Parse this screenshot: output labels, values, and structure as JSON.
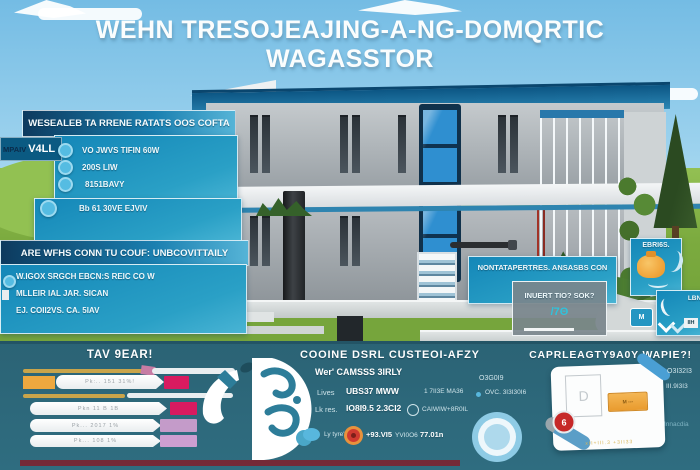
{
  "title": "WEHN TRESOJEAJING-A-NG-DOMQRTIC WAGASSTOR",
  "colors": {
    "sky": "#8fcbe9",
    "grass": "#7cab3f",
    "panel_teal": "#1f93c0",
    "panel_navy": "#0d3a5e",
    "band": "#2d6879",
    "roof_blue": "#1e6f9e",
    "glass_blue": "#2f8fd0",
    "accent_orange": "#eda83f",
    "accent_gold": "#c9a44a",
    "accent_magenta": "#d81b60",
    "accent_plum": "#c79fcb",
    "maroon_strip": "#7c2430",
    "ring_blue": "#8ecbe5",
    "badge_red": "#c62828"
  },
  "left_panel": {
    "tab_dark": "MPAIV",
    "tab_light": "V4LL",
    "header": "WESEALEB TA RRENE RATATS OOS COFTA",
    "items": [
      "VO JWVS TIFIN 60W",
      "200S LIW",
      "8151BAVY",
      "Bb 61 30VE EJVIV"
    ]
  },
  "info_panel": {
    "header": "ARE WFHS CONN TU COUF: UNBCOVITTAILY",
    "lines": [
      "W.IGOX SRGCH EBCN:S REIC CO W",
      "MLLEIR IAL JAR. SICAN",
      "EJ. COII2VS. CA.   5IAV"
    ]
  },
  "callout_panel": {
    "header": "NONTATAPERTRES. ANSASBS CON",
    "label": "INUERT TIO? SOK?",
    "value": "/7Θ"
  },
  "badge_panel": {
    "label": "EBRI6S."
  },
  "mini_panel": {
    "label": "LBNI",
    "value": "IIH",
    "monogram": "M"
  },
  "bottom": {
    "col1": {
      "title": "TAV 9EAR!",
      "bars": [
        {
          "label": "Pk:.. 151    31%!"
        },
        {
          "label": "Pkn 11 B       1B"
        },
        {
          "label": "Pk... 2017     1%"
        },
        {
          "label": "Pk...  108      1%"
        }
      ]
    },
    "col2": {
      "title": "COOINE DSRL CUSTEOI-AFZY",
      "subtitle": "Wer' CAMSSS 3IRLY",
      "row1_label": "Lives",
      "row1_value": "UBS37 MWW",
      "row1_right": "1 7II3E   MA36",
      "row2_label": "Lk res.",
      "row2_value": "IO8I9.5 2.3CI2",
      "row2_right": "CAIWIW+8R0IL",
      "foot_label": "Ly tyre'",
      "foot_v1": "+93.VI5",
      "foot_v2": "YVI0O6",
      "foot_v3": "77.01n"
    },
    "col3": {
      "title": "CAPRLEAGTY9A0Y WAPIE?!",
      "left_top": "O3G0I9",
      "left_sub": "OVC. 3I3I30I6",
      "right_top": "O3I32I3",
      "right_sub": "III.9I3I3",
      "right_note": "Innacdia",
      "card_letter": "D",
      "card_button": "M ---",
      "card_badge": "6",
      "card_note": "xII+III.3 +3II33"
    }
  }
}
